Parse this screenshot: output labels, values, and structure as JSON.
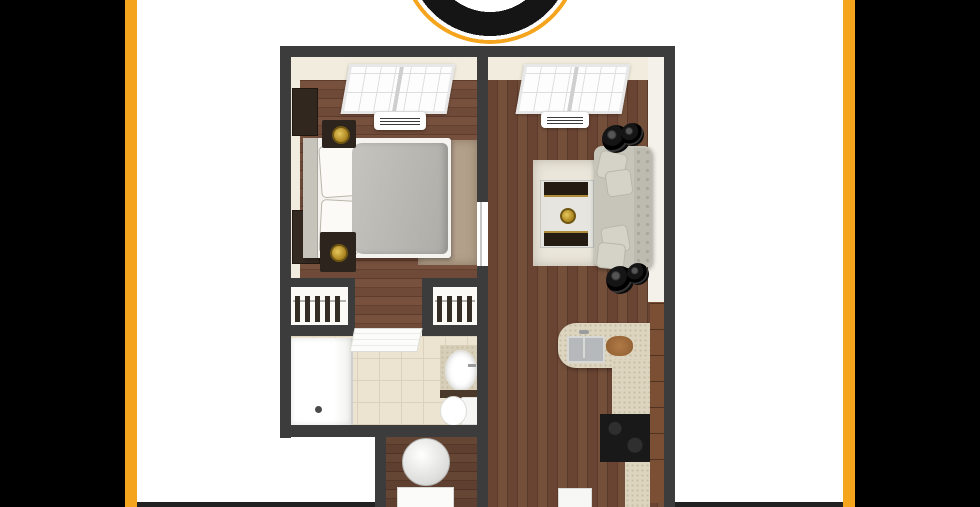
{
  "page": {
    "kind": "apartment floor plan flyer",
    "visible_text": [],
    "note": "image contains no rendered text; partial circular brand logo at top center, 3D top-down one-bedroom floor plan centered, cropped at bottom"
  },
  "theme": {
    "accent": "#F5A51D",
    "panel": "#000000",
    "wall": "#3c3c3c",
    "beige": "#f1ecdd",
    "tile": "#ece3d0",
    "granite": "#ddd5c0",
    "cabinet": "#7a4f33",
    "sofa": "#c7c4b9",
    "duvet": "#b8b6b1",
    "gold": "#c9a22b",
    "rugtan": "#b3a08b",
    "rugwhite": "#eae6db"
  },
  "frame": {
    "left_panel_color": "#000000",
    "right_panel_color": "#000000",
    "accent_stripe_color": "#F5A51D",
    "bottom_bar_color": "#222222",
    "background": "#ffffff"
  },
  "logo": {
    "icon": "circle-ring-logo-icon",
    "outer_ring_color": "#F5A51D",
    "inner_ring_color": "#151515",
    "center_color": "#ffffff",
    "position": "top-center, cropped by top edge"
  },
  "floor_plan": {
    "style": "3d-top-down-render",
    "wall_color": "#3c3c3c",
    "floor_wood_color": "#6b4636",
    "rooms": [
      {
        "id": "bedroom",
        "position": "top-left",
        "items": [
          "window",
          "hvac-unit",
          "bed-with-gray-duvet",
          "white-pillows",
          "tufted-headboard",
          "nightstand-with-gold-lamp-top",
          "nightstand-with-gold-lamp-bottom",
          "tan-shag-rug",
          "wall-art",
          "dresser"
        ]
      },
      {
        "id": "living-room",
        "position": "top-right",
        "items": [
          "window",
          "hvac-unit",
          "tufted-sofa",
          "throw-pillows-4",
          "glass-coffee-table-with-dark-gold-benches",
          "gold-decor-disc",
          "black-round-side-tables-top-pair",
          "black-round-side-tables-bottom-pair",
          "white-distressed-rug"
        ]
      },
      {
        "id": "closet-left",
        "position": "middle-left",
        "items": [
          "closet-rod",
          "hanging-clothes"
        ]
      },
      {
        "id": "closet-right",
        "position": "middle-center",
        "items": [
          "closet-rod",
          "hanging-clothes"
        ]
      },
      {
        "id": "bathroom",
        "position": "bottom-left",
        "floor": "beige-tile",
        "items": [
          "walk-in-shower",
          "shower-head",
          "open-door-panel",
          "granite-vanity",
          "white-vessel-sink",
          "faucet",
          "toilet"
        ]
      },
      {
        "id": "laundry-nook",
        "position": "bottom-center",
        "items": [
          "round-washer",
          "white-base-appliance"
        ]
      },
      {
        "id": "kitchen",
        "position": "bottom-right",
        "items": [
          "l-shaped-granite-counter",
          "double-basin-sink",
          "faucet",
          "round-cutting-board",
          "black-range-cooktop",
          "wood-cabinet-run",
          "white-appliance"
        ]
      }
    ],
    "connections": [
      {
        "between": [
          "bedroom",
          "living-room"
        ],
        "type": "open-doorway-in-divider-wall"
      },
      {
        "between": [
          "bedroom",
          "bathroom"
        ],
        "type": "hallway-past-closets"
      }
    ]
  }
}
